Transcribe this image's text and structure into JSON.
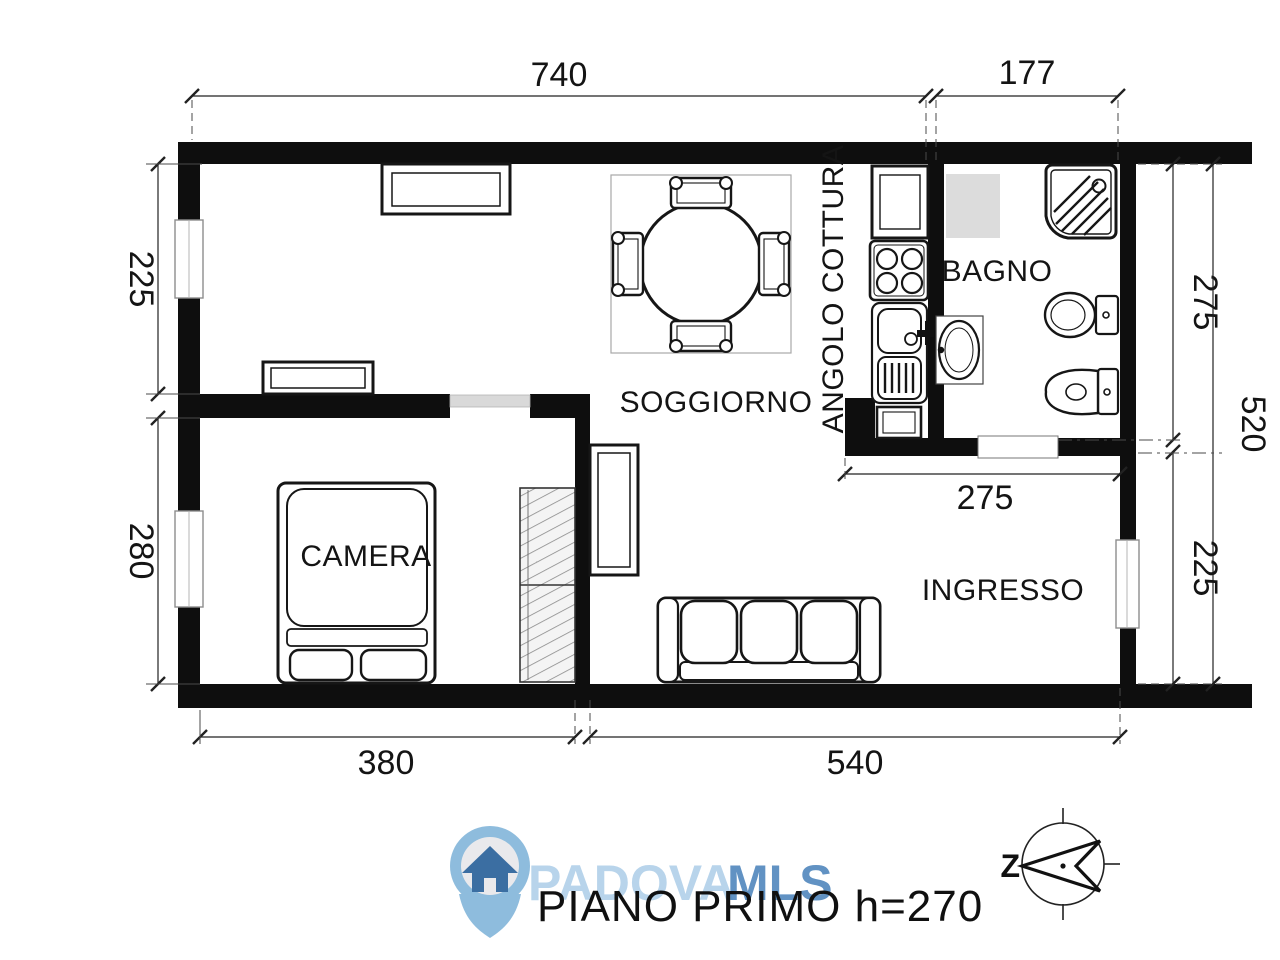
{
  "plan": {
    "title": "PIANO PRIMO h=270",
    "rooms": {
      "living": "SOGGIORNO",
      "kitchenette": "ANGOLO COTTURA",
      "bathroom": "BAGNO",
      "bedroom": "CAMERA",
      "entry": "INGRESSO"
    },
    "dimensions": {
      "top_living_width": "740",
      "top_bath_width": "177",
      "left_living_height": "225",
      "left_bedroom_height": "280",
      "right_bath_height": "275",
      "right_total_height": "520",
      "right_entry_height": "225",
      "bottom_bedroom_width": "380",
      "bottom_entry_width": "540",
      "bath_inner_width": "275"
    },
    "compass": {
      "north_label": "Z"
    },
    "watermark": {
      "name_light": "PADOVA",
      "name_bold": "MLS"
    },
    "colors": {
      "walls": "#0e0e0e",
      "watermark_light_blue": "#a3c7e5",
      "watermark_blue": "#4c84bb",
      "logo_house_blue": "#34699f",
      "logo_pin_blue": "#8abadc",
      "door_opening_gray": "#d9d9d9",
      "shower_zone_gray": "#dcdcdc"
    }
  }
}
